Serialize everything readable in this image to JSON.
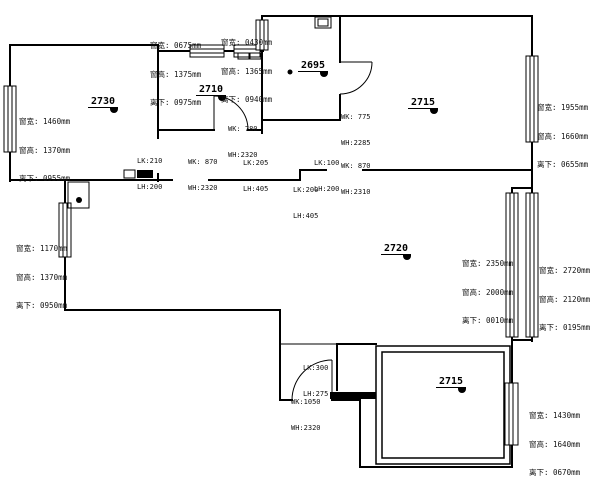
{
  "plan": {
    "title_hint": "apartment floor plan",
    "ink_color": "#000000",
    "background_color": "#ffffff",
    "rooms": [
      {
        "id": "room-2730",
        "label": "2730"
      },
      {
        "id": "room-2710",
        "label": "2710"
      },
      {
        "id": "room-2695",
        "label": "2695"
      },
      {
        "id": "room-2715-top",
        "label": "2715"
      },
      {
        "id": "room-2720",
        "label": "2720"
      },
      {
        "id": "room-2715-bottom",
        "label": "2715"
      }
    ],
    "window_notes": [
      {
        "id": "win-note-top-a",
        "lines": [
          "窗宽: 0675mm",
          "窗高: 1375mm",
          "离下: 0975mm"
        ]
      },
      {
        "id": "win-note-top-b",
        "lines": [
          "窗宽: 0430mm",
          "窗高: 1365mm",
          "离下: 0940mm"
        ]
      },
      {
        "id": "win-note-left-a",
        "lines": [
          "窗宽: 1460mm",
          "窗高: 1370mm",
          "离下: 0955mm"
        ]
      },
      {
        "id": "win-note-right-a",
        "lines": [
          "窗宽: 1955mm",
          "窗高: 1660mm",
          "离下: 0655mm"
        ]
      },
      {
        "id": "win-note-left-b",
        "lines": [
          "窗宽: 1170mm",
          "窗高: 1370mm",
          "离下: 0950mm"
        ]
      },
      {
        "id": "win-note-right-b",
        "lines": [
          "窗宽: 2350mm",
          "窗高: 2000mm",
          "离下: 0010mm"
        ]
      },
      {
        "id": "win-note-right-c",
        "lines": [
          "窗宽: 2720mm",
          "窗高: 2120mm",
          "离下: 0195mm"
        ]
      },
      {
        "id": "win-note-bottom-right",
        "lines": [
          "窗宽: 1430mm",
          "窗高: 1640mm",
          "离下: 0670mm"
        ]
      }
    ],
    "door_notes": [
      {
        "id": "door-note-2710",
        "lines": [
          "WK: 780",
          "WH:2320"
        ]
      },
      {
        "id": "door-note-hall-left",
        "lines": [
          "WK: 870",
          "WH:2320"
        ]
      },
      {
        "id": "door-note-2695",
        "lines": [
          "WK: 775",
          "WH:2285"
        ]
      },
      {
        "id": "door-note-hall-right",
        "lines": [
          "WK: 870",
          "WH:2310"
        ]
      },
      {
        "id": "door-note-corridor",
        "lines": [
          "WK:1050",
          "WH:2320"
        ]
      }
    ],
    "beam_notes": [
      {
        "id": "beam-note-a",
        "lines": [
          "LK:210",
          "LH:200"
        ]
      },
      {
        "id": "beam-note-b",
        "lines": [
          "LK:205",
          "LH:405"
        ]
      },
      {
        "id": "beam-note-c",
        "lines": [
          "LK:100",
          "LH:200"
        ]
      },
      {
        "id": "beam-note-d",
        "lines": [
          "LK:200",
          "LH:405"
        ]
      },
      {
        "id": "beam-note-e",
        "lines": [
          "LK:300",
          "LH:275"
        ]
      }
    ]
  }
}
